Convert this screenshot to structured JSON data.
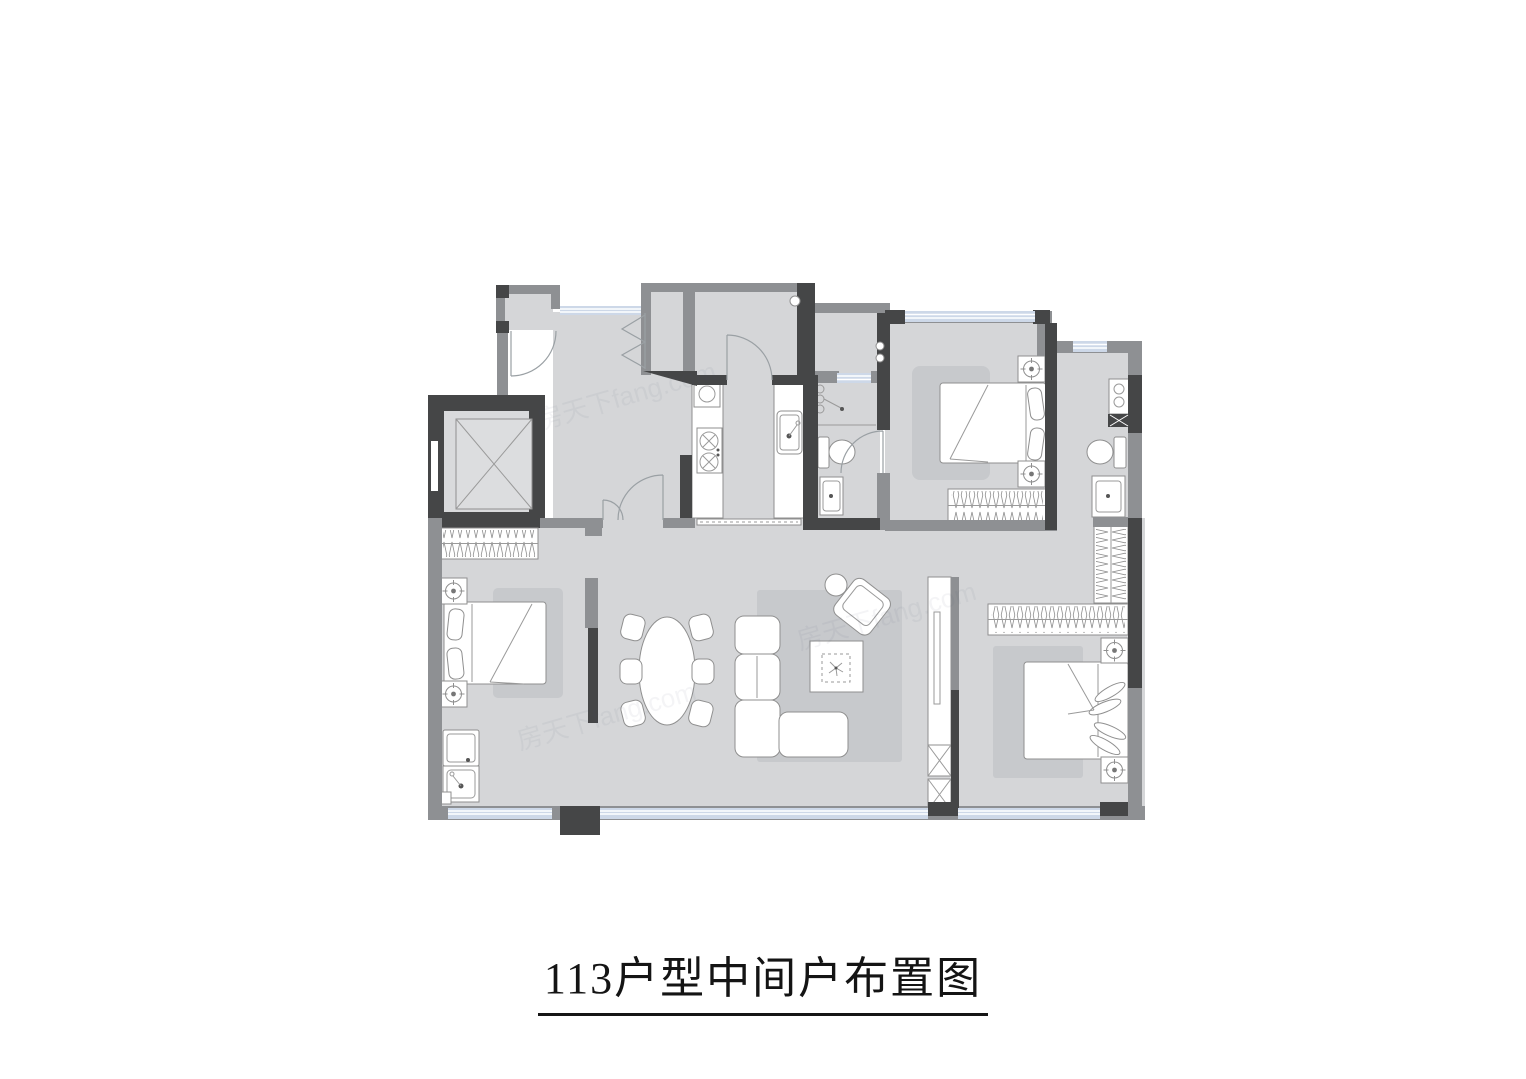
{
  "title": {
    "text": "113户型中间户布置图"
  },
  "watermark": {
    "text": "房天下fang.com"
  },
  "colors": {
    "wall_dark": "#454647",
    "wall_gray": "#8e9093",
    "floor": "#d5d6d8",
    "floor_elevator": "#d9dadc",
    "rug": "#c7c9cc",
    "window_glass": "#cdd8e8",
    "furniture_stroke": "#8f8f8f",
    "line": "#9a9a9a",
    "background": "#ffffff",
    "title_color": "#141414"
  }
}
